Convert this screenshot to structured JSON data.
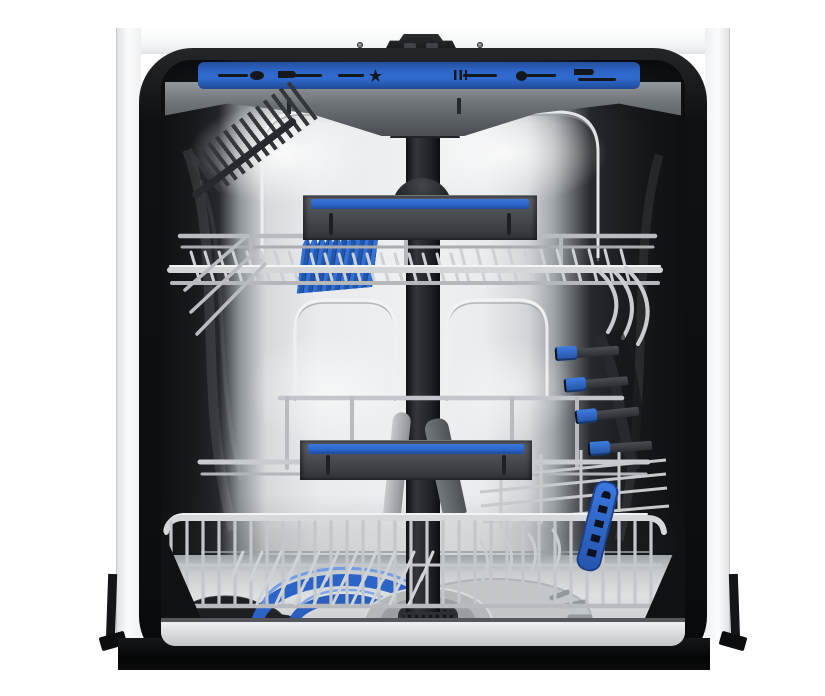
{
  "meta": {
    "alt": "Front view of an open dishwasher showing the interior: blue cutlery tray with utensil icons at top, upper and lower wire baskets with blue-striped gray handles, a blue soft-spike insert, four blue side clips on the right rail, a blue fold-down handle, and at the bottom a blue spray hose coil, circular filter assembly and dark salt cap",
    "width": 825,
    "height": 696
  },
  "colors": {
    "canvas_white": "#ffffff",
    "cabinet_white": "#f8f9fa",
    "cabinet_edge": "#c7cacd",
    "gasket_black": "#0e1013",
    "tub_wall_dark": "#17191c",
    "steel_light": "#eceeef",
    "steel_mid": "#c6cacd",
    "steel_shadow": "#8f9499",
    "accent_blue": "#2d66c9",
    "accent_blue_deep": "#22509f",
    "accent_blue_bright": "#3f7ce2",
    "handle_gray_light": "#5d6165",
    "handle_gray_dark": "#34383c",
    "icon_dark": "#14171b",
    "floor_gray": "#d6d9db",
    "filter_dark": "#2c2f33",
    "salt_cap_dark": "#232629"
  },
  "tray": {
    "icons": [
      {
        "name": "spoon-icon",
        "shape": "ico-spoon"
      },
      {
        "name": "knife-icon",
        "shape": "ico-knife"
      },
      {
        "name": "whisk-icon",
        "shape": "ico-whisk"
      },
      {
        "name": "fork-icon",
        "shape": "ico-fork"
      },
      {
        "name": "ladle-icon",
        "shape": "ico-ladle"
      },
      {
        "name": "cutlery-pair-icon",
        "shape": "ico-knives"
      }
    ]
  },
  "side_rail": {
    "clip_count": 4
  }
}
